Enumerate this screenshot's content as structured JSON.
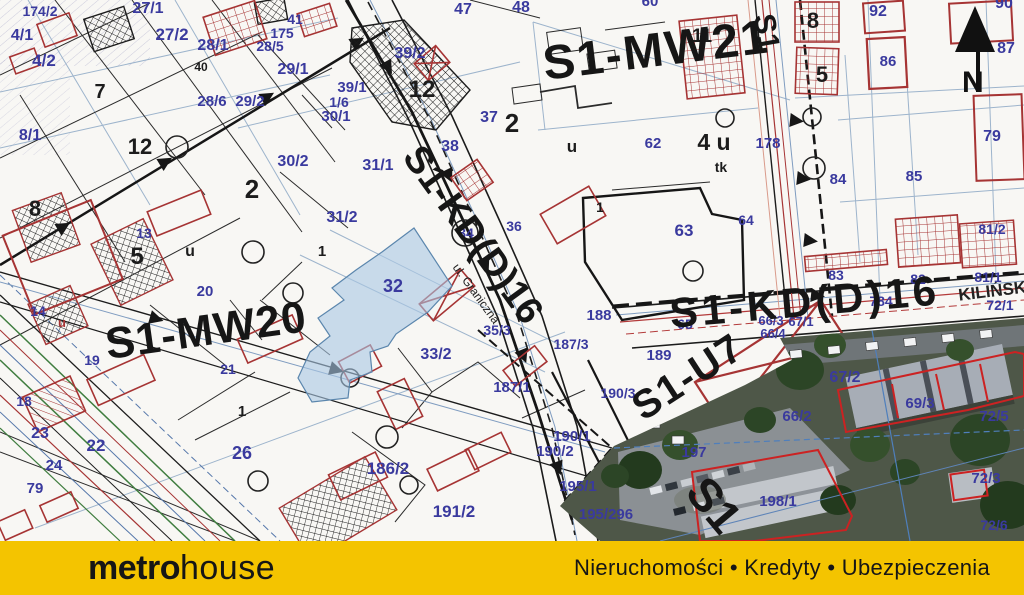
{
  "footer": {
    "brand_bold": "metro",
    "brand_light": "house",
    "tagline": "Nieruchomości • Kredyty • Ubezpieczenia",
    "bg": "#F4C400"
  },
  "north": {
    "label": "N"
  },
  "map": {
    "colors": {
      "zone_black": "#161616",
      "parcel_blue": "#3A3A9E",
      "line_red": "#A63434",
      "highlight_fill": "#A9C7E2",
      "aerial_base": "#4E5748"
    },
    "labels": {
      "zones": [
        {
          "t": "S1-MW21",
          "x": 658,
          "y": 66,
          "s": 48,
          "r": -7,
          "ls": 2
        },
        {
          "t": "S1-MW20",
          "x": 208,
          "y": 345,
          "s": 44,
          "r": -8,
          "ls": 1
        },
        {
          "t": "S1-KD(D)16",
          "x": 463,
          "y": 242,
          "s": 38,
          "r": 54
        },
        {
          "t": "S1-U7",
          "x": 695,
          "y": 388,
          "s": 40,
          "r": -33,
          "ls": 2
        },
        {
          "t": "S1-KD(D)16",
          "x": 806,
          "y": 316,
          "s": 42,
          "r": -5,
          "ls": 4
        },
        {
          "t": "S1",
          "x": 757,
          "y": 34,
          "s": 30,
          "r": 80
        },
        {
          "t": "S1",
          "x": 702,
          "y": 515,
          "s": 46,
          "r": 50
        }
      ],
      "streets": [
        {
          "t": "ul. Graniczna",
          "x": 473,
          "y": 296,
          "s": 12,
          "r": 54
        },
        {
          "t": "KILIŃSKIEGO",
          "x": 1014,
          "y": 294,
          "s": 17,
          "r": -7,
          "w": "bold"
        }
      ],
      "blacks": [
        {
          "t": "7",
          "x": 100,
          "y": 98,
          "s": 20
        },
        {
          "t": "12",
          "x": 140,
          "y": 154,
          "s": 22
        },
        {
          "t": "12",
          "x": 422,
          "y": 97,
          "s": 24
        },
        {
          "t": "2",
          "x": 512,
          "y": 132,
          "s": 26
        },
        {
          "t": "2",
          "x": 252,
          "y": 198,
          "s": 26
        },
        {
          "t": "8",
          "x": 35,
          "y": 216,
          "s": 22
        },
        {
          "t": "5",
          "x": 137,
          "y": 264,
          "s": 24
        },
        {
          "t": "8",
          "x": 813,
          "y": 28,
          "s": 22
        },
        {
          "t": "5",
          "x": 822,
          "y": 82,
          "s": 22
        },
        {
          "t": "11",
          "x": 702,
          "y": 42,
          "s": 19
        },
        {
          "t": "4 u",
          "x": 714,
          "y": 150,
          "s": 23
        },
        {
          "t": "tk",
          "x": 721,
          "y": 172,
          "s": 14
        },
        {
          "t": "40",
          "x": 201,
          "y": 71,
          "s": 12
        },
        {
          "t": "u",
          "x": 190,
          "y": 256,
          "s": 16
        },
        {
          "t": "u",
          "x": 572,
          "y": 152,
          "s": 17
        },
        {
          "t": "u",
          "x": 62,
          "y": 327,
          "s": 13,
          "c": "#A63434"
        },
        {
          "t": "1",
          "x": 322,
          "y": 256,
          "s": 15
        },
        {
          "t": "1",
          "x": 242,
          "y": 416,
          "s": 15
        },
        {
          "t": "1",
          "x": 600,
          "y": 212,
          "s": 14
        }
      ],
      "parcels": [
        {
          "t": "174/2",
          "x": 40,
          "y": 16
        },
        {
          "t": "27/1",
          "x": 148,
          "y": 13,
          "s": 16
        },
        {
          "t": "4/1",
          "x": 22,
          "y": 40,
          "s": 16
        },
        {
          "t": "4/2",
          "x": 44,
          "y": 66,
          "s": 17
        },
        {
          "t": "27/2",
          "x": 172,
          "y": 40,
          "s": 17
        },
        {
          "t": "28/1",
          "x": 213,
          "y": 50,
          "s": 16
        },
        {
          "t": "41",
          "x": 295,
          "y": 24
        },
        {
          "t": "175",
          "x": 282,
          "y": 38
        },
        {
          "t": "28/5",
          "x": 270,
          "y": 51
        },
        {
          "t": "29/1",
          "x": 293,
          "y": 74,
          "s": 16
        },
        {
          "t": "39/2",
          "x": 410,
          "y": 58,
          "s": 16
        },
        {
          "t": "47",
          "x": 463,
          "y": 14,
          "s": 16
        },
        {
          "t": "48",
          "x": 521,
          "y": 12,
          "s": 16
        },
        {
          "t": "60",
          "x": 650,
          "y": 6,
          "s": 15
        },
        {
          "t": "92",
          "x": 878,
          "y": 16,
          "s": 16
        },
        {
          "t": "90",
          "x": 1004,
          "y": 8,
          "s": 16
        },
        {
          "t": "86",
          "x": 888,
          "y": 66,
          "s": 15
        },
        {
          "t": "87",
          "x": 1006,
          "y": 53,
          "s": 16
        },
        {
          "t": "39/1",
          "x": 352,
          "y": 92,
          "s": 15
        },
        {
          "t": "1/6",
          "x": 339,
          "y": 107
        },
        {
          "t": "30/1",
          "x": 336,
          "y": 121,
          "s": 15
        },
        {
          "t": "28/6",
          "x": 212,
          "y": 106,
          "s": 15
        },
        {
          "t": "29/2",
          "x": 250,
          "y": 106,
          "s": 15
        },
        {
          "t": "8/1",
          "x": 30,
          "y": 140,
          "s": 16
        },
        {
          "t": "62",
          "x": 653,
          "y": 148,
          "s": 15
        },
        {
          "t": "178",
          "x": 768,
          "y": 148,
          "s": 15
        },
        {
          "t": "79",
          "x": 992,
          "y": 141,
          "s": 16
        },
        {
          "t": "85",
          "x": 914,
          "y": 181,
          "s": 15
        },
        {
          "t": "84",
          "x": 838,
          "y": 184,
          "s": 15
        },
        {
          "t": "30/2",
          "x": 293,
          "y": 166,
          "s": 16
        },
        {
          "t": "31/1",
          "x": 378,
          "y": 170,
          "s": 16
        },
        {
          "t": "37",
          "x": 489,
          "y": 122,
          "s": 16
        },
        {
          "t": "38",
          "x": 450,
          "y": 151,
          "s": 16
        },
        {
          "t": "81/2",
          "x": 992,
          "y": 234
        },
        {
          "t": "13",
          "x": 144,
          "y": 238
        },
        {
          "t": "14",
          "x": 38,
          "y": 316
        },
        {
          "t": "20",
          "x": 205,
          "y": 296,
          "s": 15
        },
        {
          "t": "31/2",
          "x": 342,
          "y": 222,
          "s": 16
        },
        {
          "t": "34",
          "x": 466,
          "y": 238
        },
        {
          "t": "36",
          "x": 514,
          "y": 231
        },
        {
          "t": "63",
          "x": 684,
          "y": 236,
          "s": 17
        },
        {
          "t": "64",
          "x": 746,
          "y": 225
        },
        {
          "t": "83",
          "x": 836,
          "y": 280
        },
        {
          "t": "82",
          "x": 918,
          "y": 284
        },
        {
          "t": "81/1",
          "x": 988,
          "y": 282
        },
        {
          "t": "72/1",
          "x": 1000,
          "y": 310
        },
        {
          "t": "784",
          "x": 881,
          "y": 306
        },
        {
          "t": "66/3",
          "x": 771,
          "y": 325,
          "s": 13
        },
        {
          "t": "67/1",
          "x": 801,
          "y": 326,
          "s": 13
        },
        {
          "t": "66/4",
          "x": 773,
          "y": 338,
          "s": 13
        },
        {
          "t": "32",
          "x": 393,
          "y": 292,
          "s": 18
        },
        {
          "t": "19",
          "x": 92,
          "y": 365
        },
        {
          "t": "21",
          "x": 228,
          "y": 374
        },
        {
          "t": "35/3",
          "x": 497,
          "y": 335
        },
        {
          "t": "65",
          "x": 685,
          "y": 329
        },
        {
          "t": "188",
          "x": 599,
          "y": 320,
          "s": 15
        },
        {
          "t": "187/3",
          "x": 571,
          "y": 349
        },
        {
          "t": "189",
          "x": 659,
          "y": 360,
          "s": 15
        },
        {
          "t": "33/2",
          "x": 436,
          "y": 359,
          "s": 16
        },
        {
          "t": "187/1",
          "x": 512,
          "y": 392,
          "s": 15
        },
        {
          "t": "190/3",
          "x": 618,
          "y": 398
        },
        {
          "t": "67/2",
          "x": 845,
          "y": 382,
          "s": 16
        },
        {
          "t": "69/3",
          "x": 920,
          "y": 408,
          "s": 15
        },
        {
          "t": "72/5",
          "x": 994,
          "y": 421,
          "s": 15
        },
        {
          "t": "66/2",
          "x": 797,
          "y": 421,
          "s": 15
        },
        {
          "t": "18",
          "x": 24,
          "y": 406
        },
        {
          "t": "23",
          "x": 40,
          "y": 438,
          "s": 16
        },
        {
          "t": "24",
          "x": 54,
          "y": 470,
          "s": 15
        },
        {
          "t": "79",
          "x": 35,
          "y": 493,
          "s": 15
        },
        {
          "t": "22",
          "x": 96,
          "y": 451,
          "s": 17
        },
        {
          "t": "26",
          "x": 242,
          "y": 459,
          "s": 18
        },
        {
          "t": "186/2",
          "x": 388,
          "y": 474,
          "s": 17
        },
        {
          "t": "190/1",
          "x": 572,
          "y": 441,
          "s": 15
        },
        {
          "t": "190/2",
          "x": 555,
          "y": 456,
          "s": 15
        },
        {
          "t": "195/1",
          "x": 578,
          "y": 491,
          "s": 15
        },
        {
          "t": "191/2",
          "x": 454,
          "y": 517,
          "s": 17
        },
        {
          "t": "195/296",
          "x": 606,
          "y": 519,
          "s": 15
        },
        {
          "t": "197",
          "x": 694,
          "y": 457,
          "s": 15
        },
        {
          "t": "198/1",
          "x": 778,
          "y": 506,
          "s": 15
        },
        {
          "t": "72/3",
          "x": 986,
          "y": 483,
          "s": 15
        },
        {
          "t": "72/6",
          "x": 994,
          "y": 530
        }
      ]
    }
  }
}
